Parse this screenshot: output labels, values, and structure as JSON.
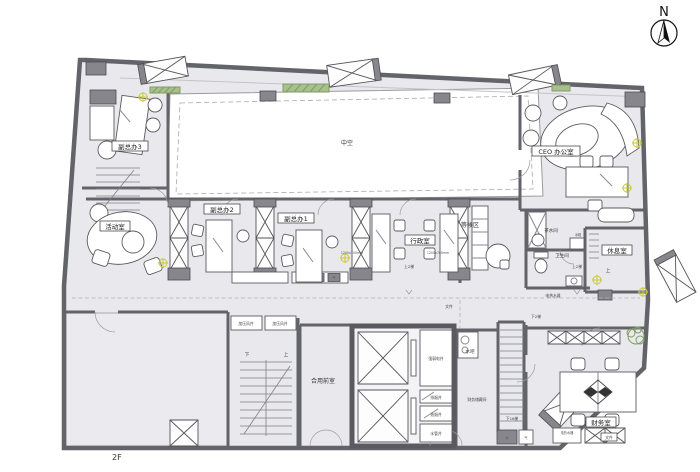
{
  "floor": {
    "label": "2F"
  },
  "compass": {
    "north": "N"
  },
  "rooms": {
    "atrium": "中空",
    "vice_office_3": "副总办3",
    "vice_office_2": "副总办2",
    "vice_office_1": "副总办1",
    "activity_room": "活动室",
    "admin_office": "行政室",
    "waiting_area": "等候区",
    "ceo_office": "CEO 办公室",
    "tea_room": "茶水间",
    "toilet": "卫生间",
    "lounge": "休息室",
    "shared_vestibule": "合用前室",
    "finance_storage": "财务储藏间",
    "finance_room": "财务室",
    "water_bar": "水吧"
  },
  "shafts": {
    "pressure_air": "加压风井",
    "electrical": "强弱电井",
    "smoke": "排烟井",
    "fume": "油烟井",
    "water_pipe": "水管井"
  },
  "annotations": {
    "up_2": "上2梯",
    "down_2": "下2梯",
    "down_16": "下16梯",
    "up": "上",
    "down": "下",
    "desk_size": "1200x700mm",
    "fridge": "冰箱",
    "files": "文件",
    "water_heater": "电热水器",
    "water": "水",
    "gas": "气"
  },
  "colors": {
    "wall": "#63636a",
    "floor": "#e9e9ed",
    "accent_yellow": "#c9c93a",
    "plant_green": "#7f9e63"
  }
}
